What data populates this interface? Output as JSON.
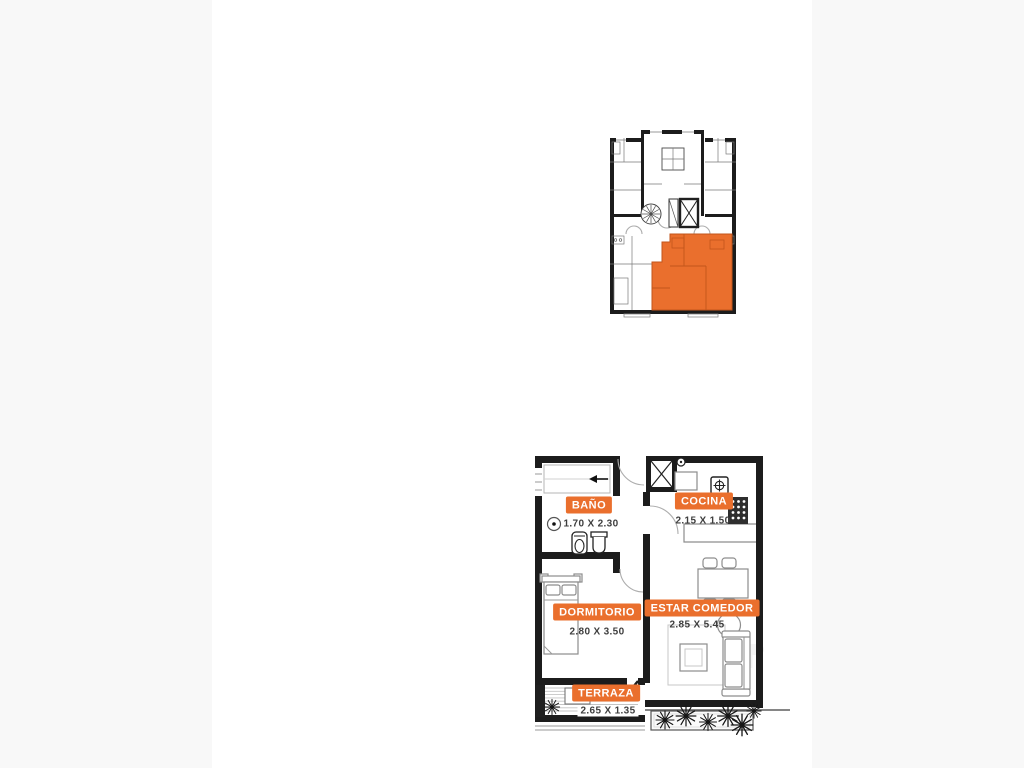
{
  "colors": {
    "accent_orange": "#EA6F2D",
    "accent_orange_dark": "#C2561B",
    "wall_black": "#1C1C1C",
    "dim_text": "#3E3E3E",
    "canvas_white": "#FFFFFF",
    "page_margin": "#F8F8F8"
  },
  "rooms": [
    {
      "id": "bano",
      "label": "BAÑO",
      "dimensions": "1.70 X 2.30"
    },
    {
      "id": "cocina",
      "label": "COCINA",
      "dimensions": "2.15 X 1.50"
    },
    {
      "id": "dormitorio",
      "label": "DORMITORIO",
      "dimensions": "2.80 X 3.50"
    },
    {
      "id": "estar_comedor",
      "label": "ESTAR COMEDOR",
      "dimensions": "2.85 X 5.45"
    },
    {
      "id": "terraza",
      "label": "TERRAZA",
      "dimensions": "2.65 X 1.35"
    }
  ]
}
